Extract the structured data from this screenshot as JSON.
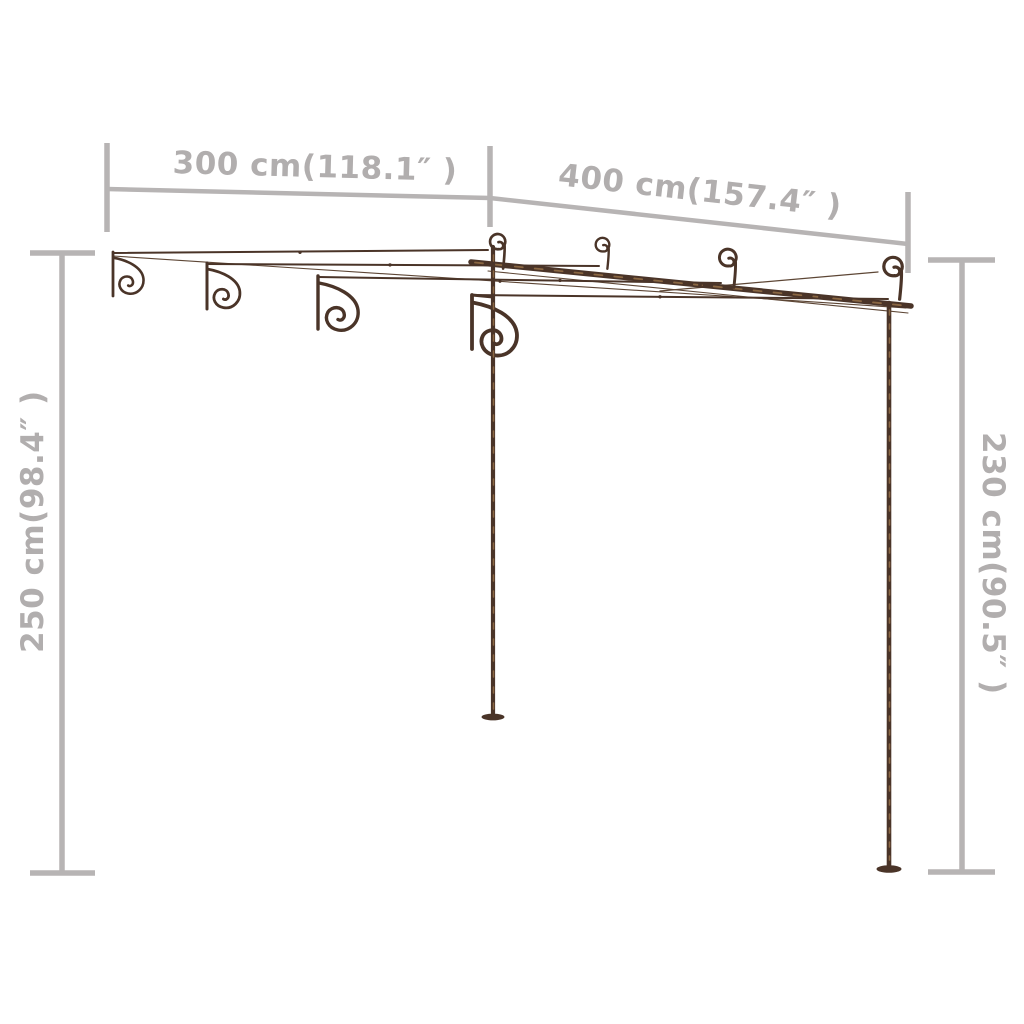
{
  "page": {
    "background": "#ffffff"
  },
  "diagram": {
    "subject": "wall-mounted-garden-pergola",
    "colors": {
      "annotation": "#b5b2b2",
      "label_text": "#b1aeae",
      "structure": "#4a3428",
      "rust_accent": "#8a6743"
    },
    "dimensions": {
      "top_width": {
        "label": "300 cm(118.1″ )",
        "cm": 300,
        "inches": 118.1,
        "orientation": "horizontal-top-left"
      },
      "top_depth": {
        "label": "400 cm(157.4″ )",
        "cm": 400,
        "inches": 157.4,
        "orientation": "horizontal-top-right"
      },
      "left_height": {
        "label": "250 cm(98.4″ )",
        "cm": 250,
        "inches": 98.4,
        "orientation": "vertical-left"
      },
      "right_height": {
        "label": "230 cm(90.5″ )",
        "cm": 230,
        "inches": 90.5,
        "orientation": "vertical-right"
      }
    }
  }
}
